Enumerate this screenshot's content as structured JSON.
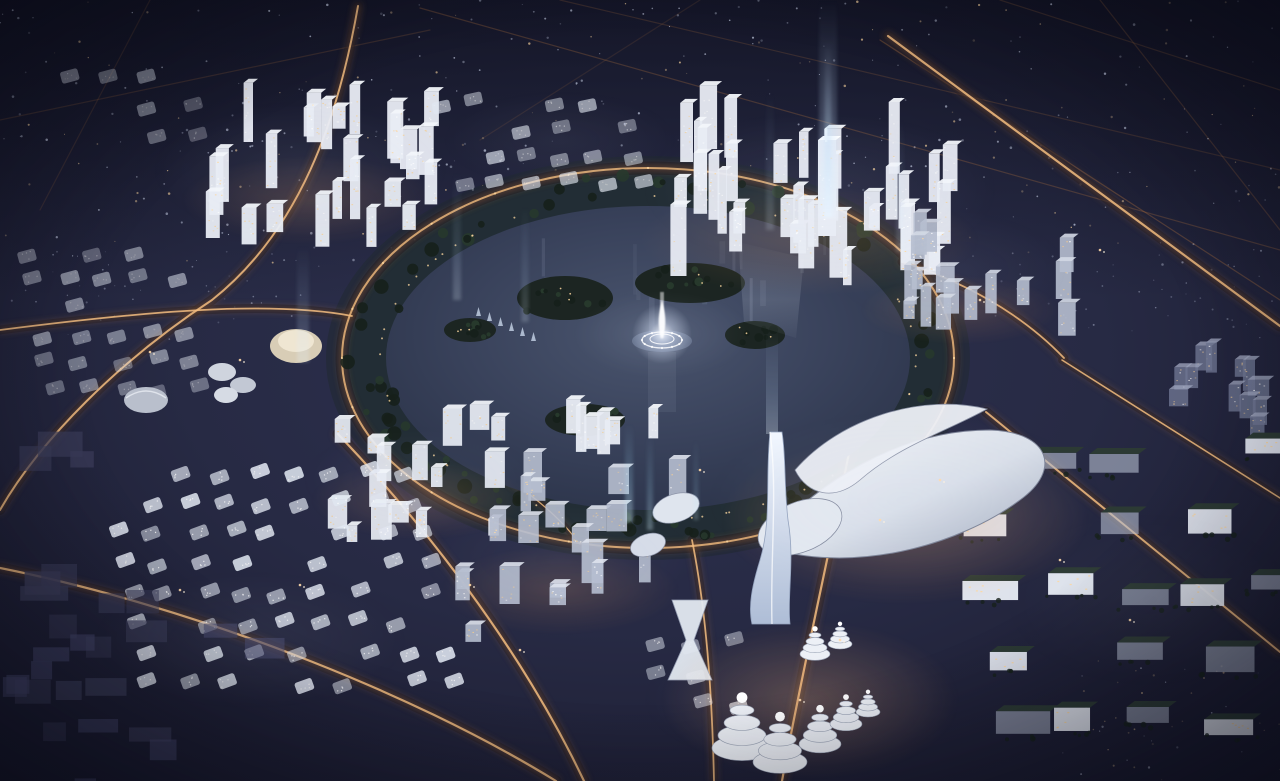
{
  "meta": {
    "description": "Aerial night rendering of a master-planned city district built around a circular central lake with an illuminated fountain, ring road, glowing towers and curved expo pavilions",
    "scene_type": "architectural rendering",
    "view": "aerial oblique",
    "time_of_day": "night"
  },
  "palette": {
    "bg_center": "#2e3150",
    "bg_mid": "#272a44",
    "bg_edge": "#151629",
    "distant_ground": "#1b1c30",
    "park_ring": "#202a31",
    "lake_center": "#4a556e",
    "lake_mid": "#39425b",
    "lake_edge": "#2b3349",
    "tree": "#16201b",
    "tree_lit": "#27392c",
    "building_bright": "#e9edf5",
    "building_top": "#f4f7fb",
    "building_mid": "#b6bed0",
    "building_dim": "#6f7692",
    "building_dark": "#3a3c58",
    "roof_green": "#2c3a34",
    "window_warm": "#ffd9a0",
    "window_cool": "#ffffff",
    "road_asphalt": "#0f1120",
    "road_core": "#f3bd80",
    "road_soft": "#c97f3f",
    "beam_blue": "#c6e2fa",
    "beam_cyan": "#9fd8f2",
    "fountain": "#ffffff",
    "plaza_warm": "#e89a5a",
    "bloom": "#dfe8ff"
  },
  "landmarks": {
    "central_lake": "Circular central lake",
    "fountain": "Central lake fountain",
    "cbd_tower": "CBD landmark tower with light beam",
    "expo_swoosh": "Curved swoosh-roof expo complex",
    "spiral_pavilions": "Spiral terraced pavilions",
    "twist_tower": "Twisting tower",
    "dome_hall": "Domed hall complex",
    "ring_road": "Lakeside ring road",
    "residential_blocks": "Illuminated residential blocks",
    "office_park": "Office park grid"
  }
}
